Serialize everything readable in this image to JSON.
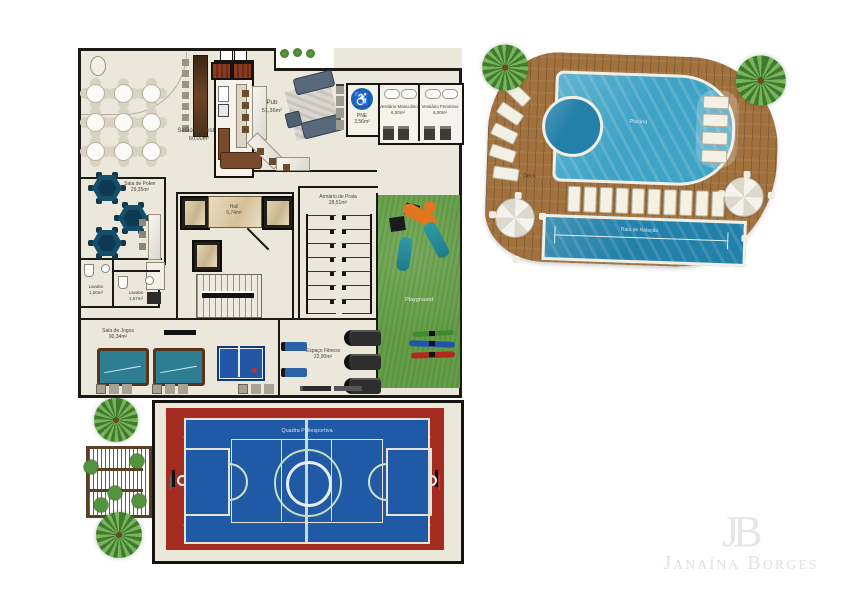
{
  "colors": {
    "floor": "#ece7db",
    "wall": "#1d1915",
    "water": "#3fa3c5",
    "lap_water": "#2280a9",
    "deck": "#a1713e",
    "grass": "#649f47",
    "court_red": "#a52c20",
    "court_blue": "#2059a5",
    "felt_teal": "#2e7e92",
    "poker_navy": "#144e6b",
    "pne_blue": "#1767a9"
  },
  "icons": {
    "accessible_glyph": "♿"
  },
  "watermark": {
    "monogram": "JB",
    "name": "Janaína Borges"
  },
  "rooms": {
    "salao_festas": {
      "name": "Salão de Festas",
      "area": "60,00m²"
    },
    "pub": {
      "name": "Pub",
      "area": "51,36m²"
    },
    "wc_pne": {
      "name": "PNE",
      "area": "3,56m²"
    },
    "vestiario_masculino": {
      "name": "Vestiário Masculino",
      "area": "6,00m²"
    },
    "vestiario_feminino": {
      "name": "Vestiário Feminino",
      "area": "6,00m²"
    },
    "piscina": {
      "name": "Piscina"
    },
    "deck": {
      "name": "Deck"
    },
    "raia_natacao": {
      "name": "Raia de Natação"
    },
    "hall": {
      "name": "Hall",
      "area": "6,74m²"
    },
    "armario_praia": {
      "name": "Armário de Praia",
      "area": "28,51m²"
    },
    "sala_poker": {
      "name": "Sala de Poker",
      "area": "29,35m²"
    },
    "lavabo_1": {
      "name": "Lavabo",
      "area": "1,50m²"
    },
    "lavabo_2": {
      "name": "Lavabo",
      "area": "1,57m²"
    },
    "playground": {
      "name": "Playground"
    },
    "sala_jogos": {
      "name": "Sala de Jogos",
      "area": "90,34m²"
    },
    "espaco_fitness": {
      "name": "Espaço Fitness",
      "area": "22,90m²"
    },
    "quadra": {
      "name": "Quadra Poliesportiva"
    }
  }
}
